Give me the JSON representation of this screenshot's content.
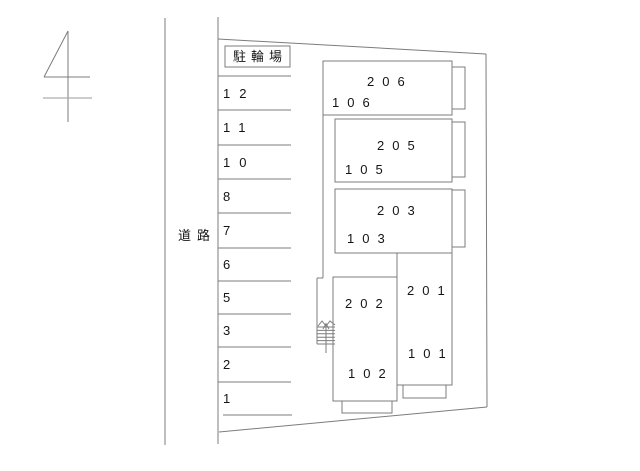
{
  "plan": {
    "road_label": "道路",
    "bicycle_parking_label": "駐輪場",
    "parking_spaces": [
      "12",
      "11",
      "10",
      "8",
      "7",
      "6",
      "5",
      "3",
      "2",
      "1"
    ],
    "units": {
      "second_floor": [
        "206",
        "205",
        "203",
        "202",
        "201"
      ],
      "first_floor": [
        "106",
        "105",
        "103",
        "102",
        "101"
      ]
    }
  }
}
